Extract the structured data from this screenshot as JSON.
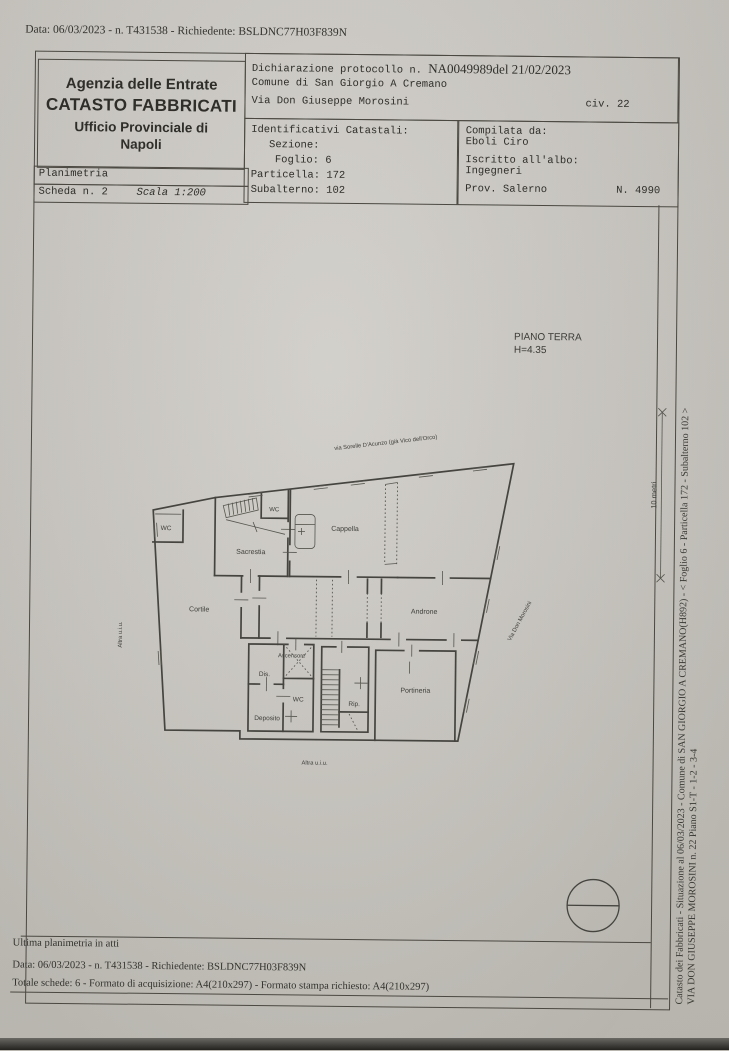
{
  "scan_header": {
    "line": "Data: 06/03/2023 - n. T431538 - Richiedente: BSLDNC77H03F839N"
  },
  "agency_box": {
    "line1": "Agenzia delle Entrate",
    "line2": "CATASTO FABBRICATI",
    "line3": "Ufficio Provinciale di",
    "line4": "Napoli"
  },
  "planimetria_box": {
    "title": "Planimetria",
    "scheda": "Scheda n. 2",
    "scala": "Scala 1:200"
  },
  "declaration_box": {
    "protocol_label": "Dichiarazione protocollo n.",
    "protocol_value": "NA0049989del  21/02/2023",
    "comune": "Comune di San Giorgio A Cremano",
    "via": "Via Don Giuseppe Morosini",
    "civ": "civ. 22"
  },
  "cadastral_box": {
    "title": "Identificativi Catastali:",
    "sezione": "Sezione:",
    "foglio": "Foglio: 6",
    "particella": "Particella: 172",
    "subalterno": "Subalterno: 102"
  },
  "compiler_box": {
    "compilata_label": "Compilata da:",
    "compilata_name": "Eboli Ciro",
    "albo_label": "Iscritto all'albo:",
    "albo_value": "Ingegneri",
    "prov": "Prov. Salerno",
    "numero": "N. 4990"
  },
  "plan": {
    "floor": "PIANO TERRA",
    "height": "H=4.35",
    "street_top": "via Sorelle D'Acunzo (già Vico dell'Orco)",
    "street_right": "Via Don Morosini",
    "rooms": {
      "wc_left": "WC",
      "wc_top": "WC",
      "sacrestia": "Sacrestia",
      "cappella": "Cappella",
      "cortile": "Cortile",
      "androne": "Androne",
      "ascensore": "Ascensore",
      "dis": "Dis.",
      "wc_bottom": "WC",
      "deposito": "Deposito",
      "rip": "Rip.",
      "portineria": "Portineria"
    },
    "altra_uiu_left": "Altra u.i.u.",
    "altra_uiu_bottom": "Altra u.i.u.",
    "scale_bar": "10 metri"
  },
  "margin_text": {
    "line1": "Catasto dei Fabbricati - Situazione al 06/03/2023 - Comune di SAN GIORGIO A CREMANO(H892) - <  Foglio 6 - Particella  172 - Subalterno 102 >",
    "line2": "VIA DON GIUSEPPE MOROSINI n. 22 Piano S1-T - 1-2 - 3-4"
  },
  "footer": {
    "line1": "Ultima planimetria in atti",
    "line2": "Data: 06/03/2023 - n. T431538 - Richiedente: BSLDNC77H03F839N",
    "line3": "Totale schede: 6 - Formato di acquisizione: A4(210x297)  - Formato stampa richiesto: A4(210x297)"
  },
  "colors": {
    "paper": "#c8c5bf",
    "ink": "#2f2e29",
    "line": "#45443e"
  }
}
